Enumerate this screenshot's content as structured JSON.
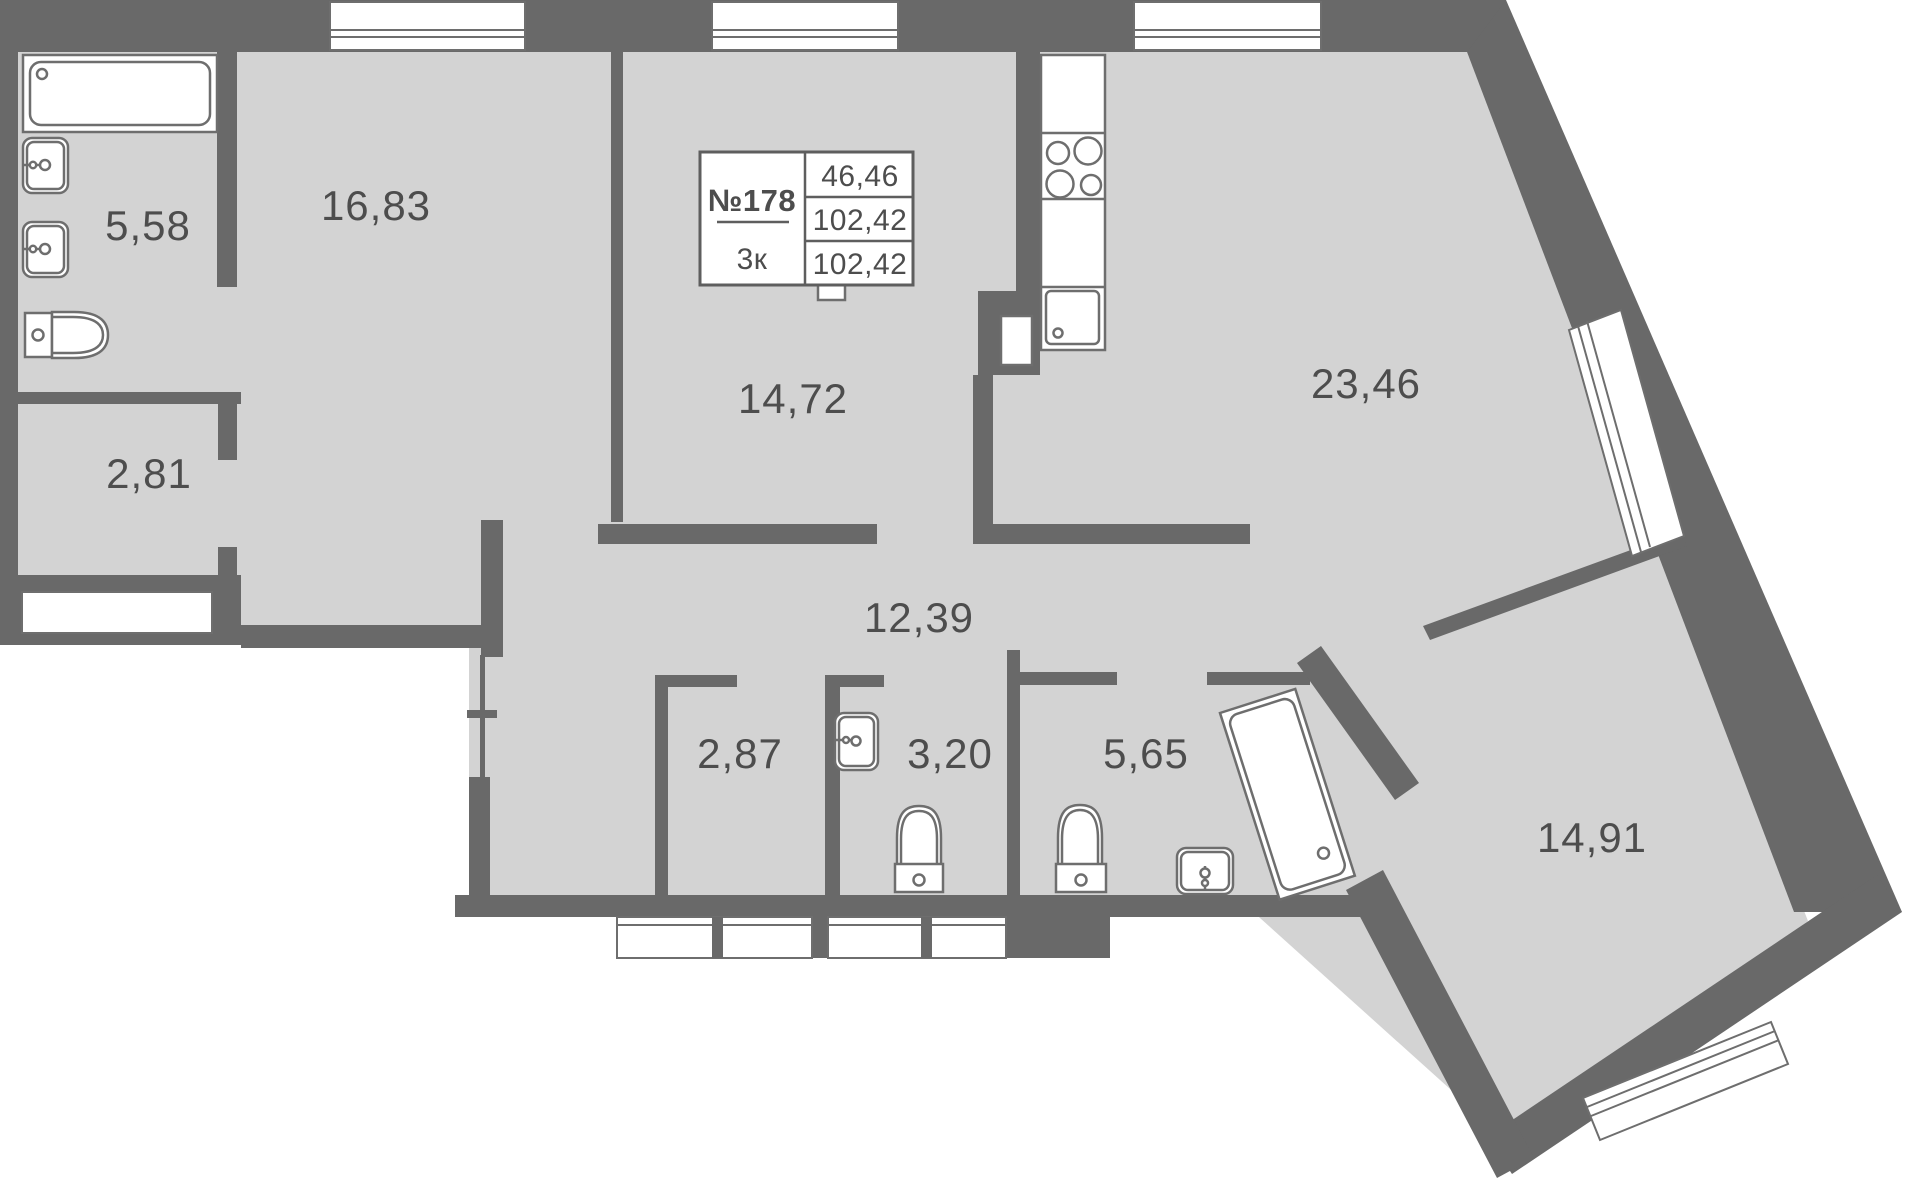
{
  "title": "Apartment floor plan",
  "unit": {
    "number": "№178",
    "rooms_label": "3к",
    "area_living": "46,46",
    "area_total": "102,42",
    "area_total_2": "102,42"
  },
  "rooms": [
    {
      "name": "bathroom-top",
      "area": "5,58",
      "x": 148,
      "y": 240
    },
    {
      "name": "bedroom-1",
      "area": "16,83",
      "x": 376,
      "y": 220
    },
    {
      "name": "bedroom-2",
      "area": "14,72",
      "x": 793,
      "y": 413
    },
    {
      "name": "kitchen-living",
      "area": "23,46",
      "x": 1366,
      "y": 398
    },
    {
      "name": "storage",
      "area": "2,81",
      "x": 149,
      "y": 488
    },
    {
      "name": "hallway",
      "area": "12,39",
      "x": 919,
      "y": 632
    },
    {
      "name": "wardrobe",
      "area": "2,87",
      "x": 740,
      "y": 768
    },
    {
      "name": "wc",
      "area": "3,20",
      "x": 950,
      "y": 768
    },
    {
      "name": "bathroom-2",
      "area": "5,65",
      "x": 1146,
      "y": 768
    },
    {
      "name": "bedroom-3",
      "area": "14,91",
      "x": 1592,
      "y": 852
    }
  ],
  "colors": {
    "wall": "#696969",
    "floor": "#d3d3d3",
    "fixture_outline": "#6e6e6e",
    "text": "#4d4d4d",
    "background": "#ffffff",
    "info_border": "#5e5e5e"
  }
}
